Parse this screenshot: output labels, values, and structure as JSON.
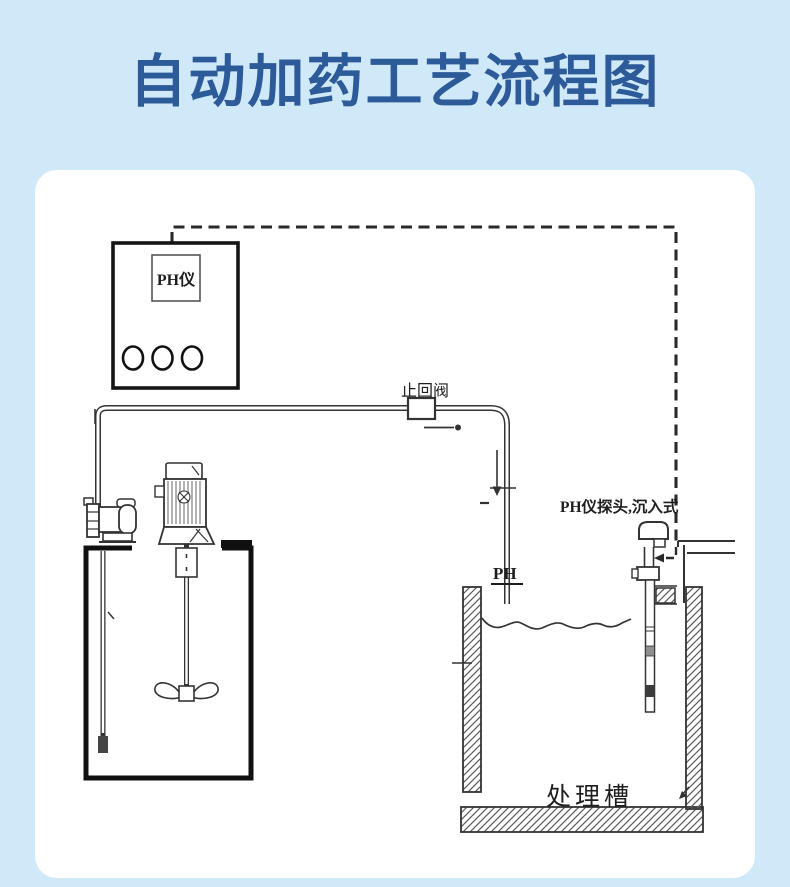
{
  "page": {
    "title": "自动加药工艺流程图",
    "background_color": "#cfe9f8",
    "title_color": "#2d5a99",
    "card_color": "#ffffff",
    "line_color": "#333333"
  },
  "diagram": {
    "controller": {
      "label": "PH仪",
      "knob_count": 3
    },
    "labels": {
      "check_valve": "止回阀",
      "ph_point": "PH",
      "probe": "PH仪探头,沉入式",
      "treatment_tank": "处理槽"
    }
  }
}
